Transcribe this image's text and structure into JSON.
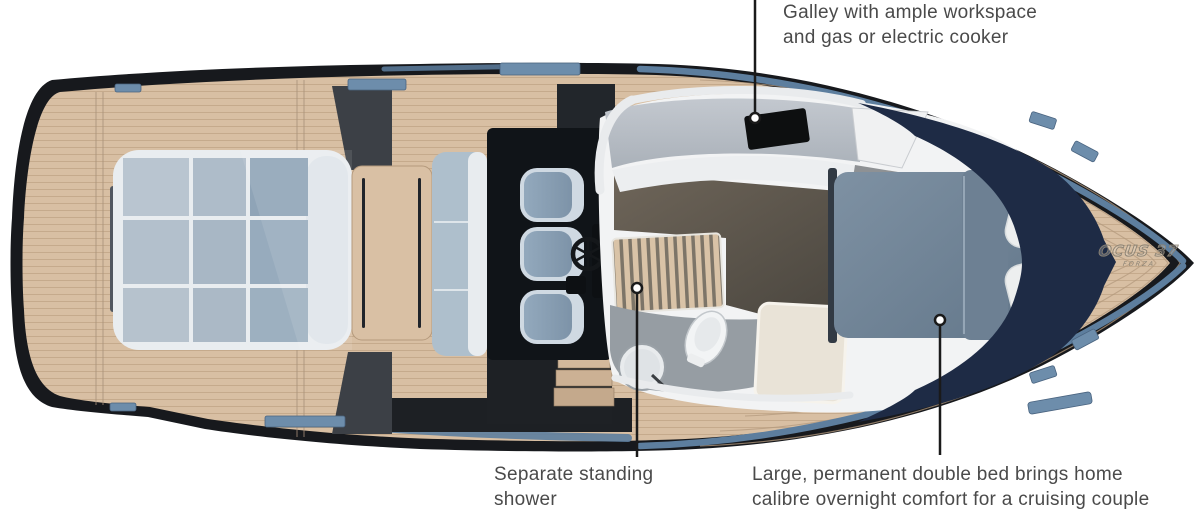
{
  "annotations": {
    "galley": {
      "lines": [
        "Galley with ample workspace",
        "and gas or electric cooker"
      ]
    },
    "shower": {
      "lines": [
        "Separate standing",
        "shower"
      ]
    },
    "bed": {
      "lines": [
        "Large, permanent double bed brings home",
        "calibre overnight comfort for a cruising couple"
      ]
    }
  },
  "bow_logo": {
    "text": "OCUS 37",
    "subtext": "FORZA"
  },
  "colors": {
    "hull_black": "#17191d",
    "accent_blue": "#5d7e9e",
    "teak": "#d8bfa3",
    "teak_seam": "#b59878",
    "cushion_blue": "#9fb2c4",
    "trim_white": "#eceef0",
    "hatch_blue": "#6d8dab",
    "counter_gray": "#b6bcc3",
    "cabin_floor_brown": "#5f584f",
    "bathroom_gray": "#969da3",
    "duvet_blue": "#72859a",
    "bow_navy": "#1e2b45",
    "label_text": "#4a4a4a",
    "leader_black": "#1a1a1a"
  }
}
